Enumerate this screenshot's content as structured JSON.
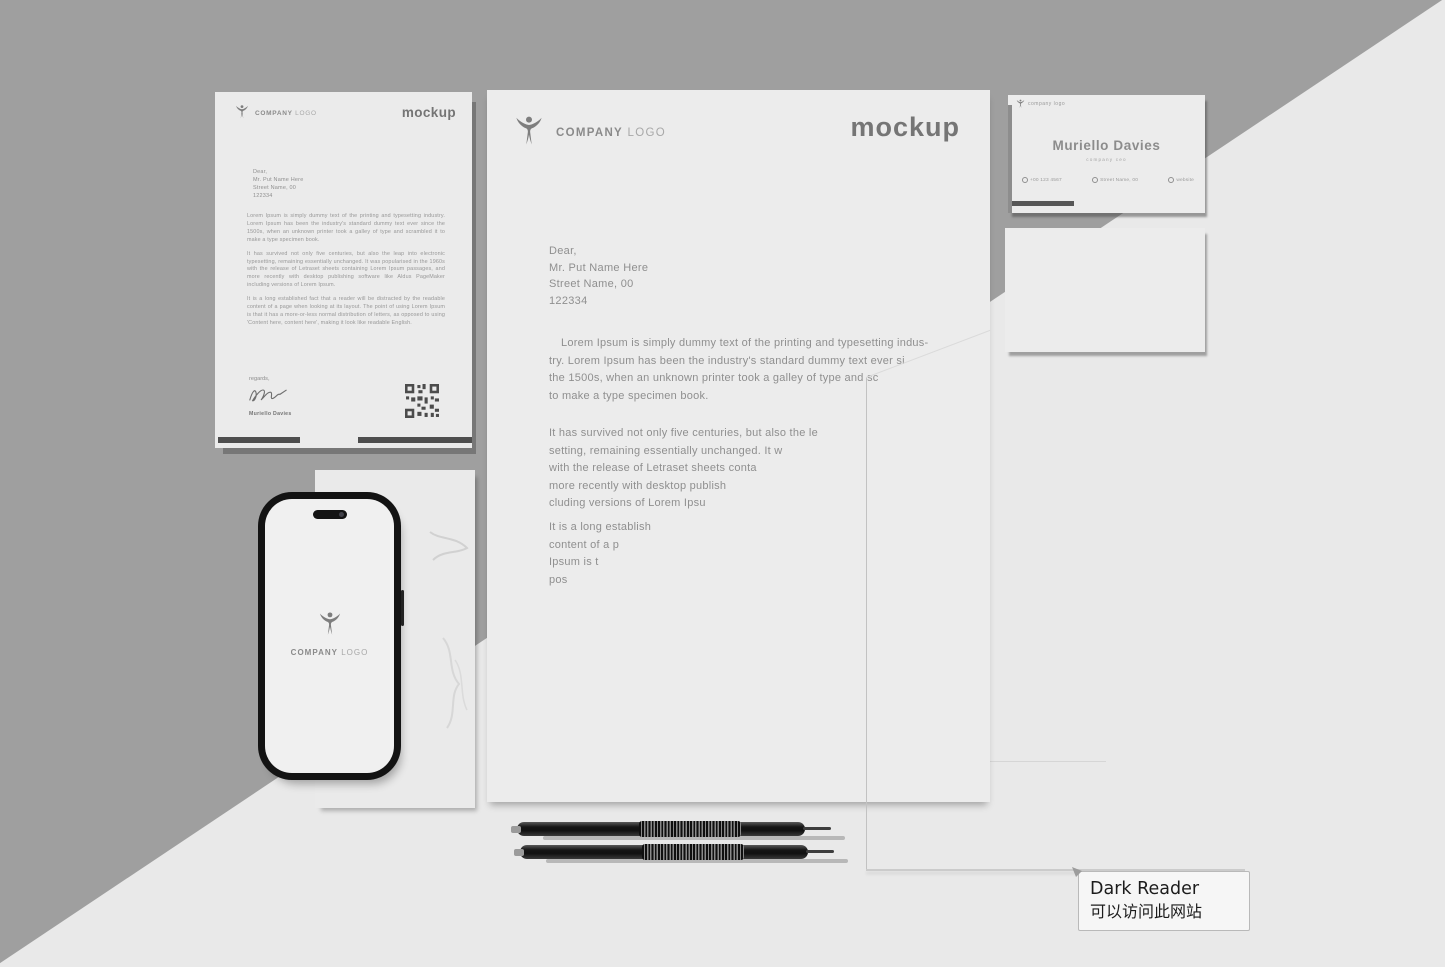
{
  "scene": {
    "label": "stationery branding mockup"
  },
  "colors": {
    "background_dark": "#9f9f9f",
    "background_light": "#e9e9e9",
    "paper": "#ececec",
    "ink": "#8f8f8f",
    "wordmark": "#757575",
    "phone_frame": "#131313"
  },
  "brand": {
    "name_bold": "COMPANY",
    "name_light": "LOGO",
    "wordmark": "mockup",
    "logo_icon": "person-figure-logo"
  },
  "letterhead_large": {
    "recipient_lines": [
      "Dear,",
      "Mr. Put Name Here",
      "Street Name, 00",
      "122334"
    ],
    "paragraph1_lines": [
      "Lorem Ipsum is simply dummy text of the printing and typesetting indus-",
      "try. Lorem Ipsum has been the industry's standard dummy text ever si",
      "the 1500s, when an unknown printer took a galley of type and sc",
      "to make a type specimen book."
    ],
    "paragraph2_lines": [
      "It has survived not only five centuries, but also the le",
      "setting, remaining essentially unchanged. It w",
      "with the release of Letraset sheets conta",
      "more recently with desktop publish",
      "cluding versions of Lorem Ipsu"
    ],
    "paragraph3_lines": [
      "It is a long establish",
      "content of a p",
      "Ipsum is t",
      "pos"
    ]
  },
  "letterhead_small": {
    "recipient_lines": [
      "Dear,",
      "Mr. Put Name Here",
      "Street Name, 00",
      "122334"
    ],
    "paragraphs": [
      "Lorem Ipsum is simply dummy text of the printing and typesetting industry. Lorem Ipsum has been the industry's standard dummy text ever since the 1500s, when an unknown printer took a galley of type and scrambled it to make a type specimen book.",
      "It has survived not only five centuries, but also the leap into electronic typesetting, remaining essentially unchanged. It was popularised in the 1960s with the release of Letraset sheets containing Lorem Ipsum passages, and more recently with desktop publishing software like Aldus PageMaker including versions of Lorem Ipsum.",
      "It is a long established fact that a reader will be distracted by the readable content of a page when looking at its layout. The point of using Lorem Ipsum is that it has a more-or-less normal distribution of letters, as opposed to using 'Content here, content here', making it look like readable English."
    ],
    "closing": "regards,",
    "signatory": "Muriello Davies"
  },
  "business_card": {
    "brand_label": "company logo",
    "name": "Muriello Davies",
    "title": "company ceo",
    "contacts": [
      {
        "icon": "phone-icon",
        "label": "+00 123 4567"
      },
      {
        "icon": "location-icon",
        "label": "Street Name, 00"
      },
      {
        "icon": "globe-icon",
        "label": "website"
      }
    ]
  },
  "dark_reader_popup": {
    "title": "Dark Reader",
    "message": "可以访问此网站"
  }
}
